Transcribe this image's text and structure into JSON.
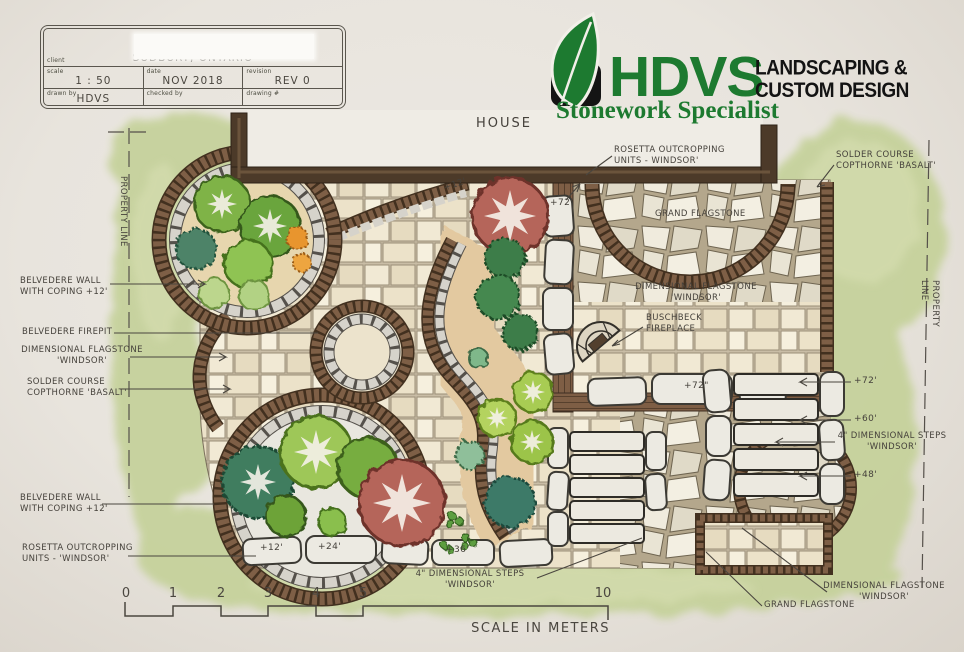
{
  "title_block": {
    "client_label": "client",
    "client_value": "SUDBURY, ONTARIO",
    "scale_label": "scale",
    "scale_value": "1 : 50",
    "date_label": "date",
    "date_value": "NOV 2018",
    "revision_label": "revision",
    "revision_value": "REV 0",
    "drawn_by_label": "drawn by",
    "drawn_by_value": "HDVS",
    "checked_by_label": "checked by",
    "checked_by_value": "",
    "drawing_no_label": "drawing #",
    "drawing_no_value": ""
  },
  "logo": {
    "name": "HDVS",
    "tagline": "LANDSCAPING &\nCUSTOM DESIGN",
    "subtitle": "Stonework Specialist",
    "green": "#1d7a30",
    "black": "#141414"
  },
  "labels": {
    "house": "HOUSE",
    "rosetta_top": "ROSETTA OUTCROPPING\nUNITS - WINDSOR'",
    "solder_top_right": "SOLDER COURSE\nCOPTHORNE 'BASALT'",
    "property_line_left": "PROPERTY LINE",
    "property_line_right": "PROPERTY LINE",
    "belvedere_wall_top": "BELVEDERE WALL\nWITH COPING  +12'",
    "belvedere_firepit": "BELVEDERE FIREPIT",
    "dimensional_flagstone_left": "DIMENSIONAL FLAGSTONE\n'WINDSOR'",
    "solder_left": "SOLDER COURSE\nCOPTHORNE 'BASALT'",
    "belvedere_wall_bottom": "BELVEDERE WALL\nWITH COPING +12'",
    "rosetta_bottom": "ROSETTA OUTCROPPING\nUNITS - 'WINDSOR'",
    "grand_flagstone_top": "GRAND FLAGSTONE",
    "dimensional_flagstone_center": "DIMENSIONAL FLAGSTONE\n'WINDSOR'",
    "buschbeck": "BUSCHBECK\nFIREPLACE",
    "steps_right": "4\" DIMENSIONAL STEPS\n'WINDSOR'",
    "steps_bottom": "4\" DIMENSIONAL STEPS\n'WINDSOR'",
    "grand_flagstone_bottom": "GRAND FLAGSTONE",
    "dimensional_flagstone_bottom": "DIMENSIONAL FLAGSTONE\n'WINDSOR'"
  },
  "measurements": {
    "plus12_top": "+12'",
    "plus72_top": "+72'",
    "plus72_wall": "+72\"",
    "plus72_right": "+72'",
    "plus60_right": "+60'",
    "plus48_right": "+48'",
    "plus12_bed": "+12'",
    "plus24_bed": "+24'",
    "plus36_bottom": "+36'"
  },
  "scale_bar": {
    "ticks": [
      "0",
      "1",
      "2",
      "3",
      "4",
      "5",
      "10"
    ],
    "caption": "SCALE IN METERS"
  }
}
